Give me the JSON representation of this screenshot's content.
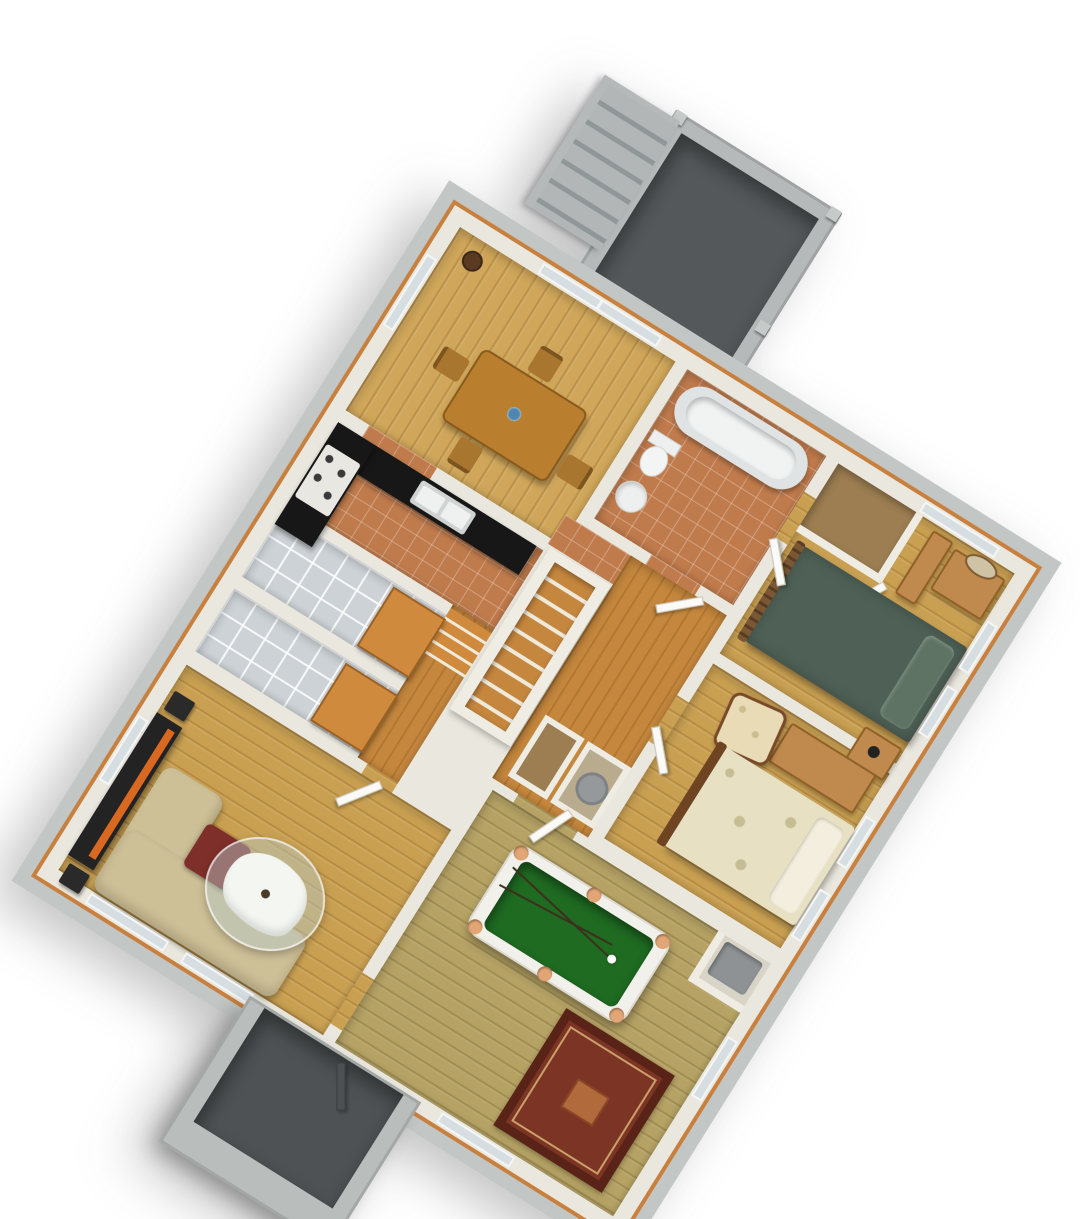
{
  "scene": {
    "type": "3d-isometric-floor-plan-render",
    "description": "Single-storey house interior floor plan shown in plan-oblique (military) 3D projection, rotated about 32 degrees, white walls with orange top trim over a gray concrete foundation, no visible text labels",
    "projection": {
      "style": "plan-oblique",
      "rotation_deg": 32
    },
    "background": "#ffffff"
  },
  "palette": {
    "wall_top": "#eae7de",
    "exterior_concrete": "#c2c6c5",
    "trim_orange": "#c8803f",
    "wood_light": "#cfa65a",
    "wood_bedroom": "#c9a052",
    "wood_gameroom_olive": "#b5a264",
    "wood_hallway": "#c5873d",
    "tile_terracotta": "#c07b4c",
    "tile_gray": "#ccd2d6",
    "porch_floor_dark": "#54585a",
    "porch_wall_gray": "#b5b9b9",
    "pool_felt_green": "#1f6b22",
    "pool_pocket_tan": "#e2a575",
    "bed1_green": "#4f6156",
    "bed2_damask_cream": "#e7e0c2",
    "rug_red": "#7c3424",
    "sofa_beige": "#cdbf96",
    "cushion_red": "#7e2f2a",
    "media_console_black": "#232323",
    "media_accent_orange": "#d96820",
    "counter_black": "#171717"
  },
  "rooms": [
    {
      "id": "rear-porch",
      "name": "Rear porch / deck",
      "floor": "dark gray concrete",
      "features": [
        "railing walls",
        "corner posts",
        "side steps"
      ]
    },
    {
      "id": "dining-room",
      "name": "Dining room",
      "floor": "light oak plank",
      "furniture": [
        "dining table",
        "4 chairs",
        "blue centerpiece",
        "plant pot"
      ],
      "openings": [
        "sliding glass door to rear porch"
      ]
    },
    {
      "id": "kitchen",
      "name": "Kitchen",
      "floor": "terracotta tile",
      "furniture": [
        "L-shaped black counter",
        "stainless double sink",
        "cooktop with 4 burners"
      ]
    },
    {
      "id": "bathroom",
      "name": "Bathroom",
      "floor": "terracotta tile",
      "furniture": [
        "bathtub",
        "toilet",
        "pedestal sink"
      ]
    },
    {
      "id": "bedroom-1",
      "name": "Bedroom 1",
      "floor": "oak plank",
      "furniture": [
        "closet",
        "armoire",
        "dresser with mirror",
        "double bed with green bedding",
        "nightstand with lamp"
      ]
    },
    {
      "id": "bedroom-2",
      "name": "Bedroom 2",
      "floor": "oak plank",
      "furniture": [
        "upholstered armchair",
        "low cabinet",
        "double bed with cream damask bedding",
        "wood footboard"
      ]
    },
    {
      "id": "hallway",
      "name": "Hallway",
      "floor": "orange wood",
      "features": [
        "staircase to basement",
        "linen closet",
        "utility closet with round water heater",
        "doors to bedrooms and bathroom"
      ]
    },
    {
      "id": "storage-room-a",
      "name": "Storage / laundry room A",
      "floor": "gray tile",
      "furniture": [
        "wood bench"
      ]
    },
    {
      "id": "storage-room-b",
      "name": "Storage / laundry room B",
      "floor": "gray tile",
      "furniture": [
        "wood bench"
      ]
    },
    {
      "id": "stair-landing",
      "name": "Landing with steps",
      "floor": "orange wood",
      "features": [
        "short stair run"
      ]
    },
    {
      "id": "living-room",
      "name": "Living room",
      "floor": "oak plank",
      "furniture": [
        "black media console with orange accent",
        "2 speakers",
        "floor lamp",
        "beige sectional sofa",
        "dark red accent cushion",
        "kidney-shaped glass coffee table with ornament"
      ]
    },
    {
      "id": "game-room",
      "name": "Game room",
      "floor": "olive oak plank",
      "furniture": [
        "white pool table with green felt and tan pockets",
        "2 cue sticks",
        "white cue ball",
        "red oriental area rug",
        "appliance closet"
      ]
    },
    {
      "id": "front-porch",
      "name": "Front entry porch",
      "floor": "dark gray concrete",
      "features": [
        "gray walls",
        "front door"
      ]
    }
  ],
  "window_count": 11,
  "door_count": 7
}
